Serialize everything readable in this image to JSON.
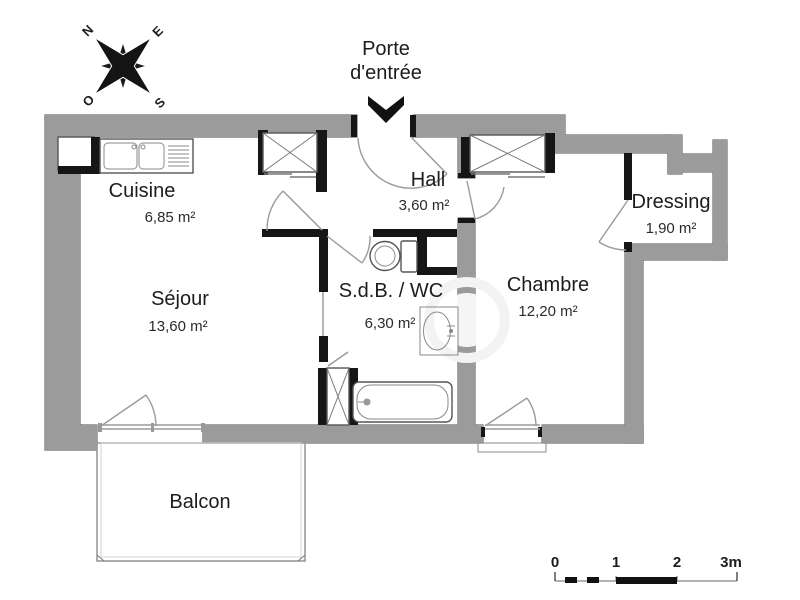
{
  "entry": {
    "line1": "Porte",
    "line2": "d'entrée"
  },
  "compass": {
    "n": "N",
    "e": "E",
    "s": "S",
    "w": "O"
  },
  "rooms": {
    "cuisine": {
      "name": "Cuisine",
      "area": "6,85 m²"
    },
    "hall": {
      "name": "Hall",
      "area": "3,60 m²"
    },
    "dressing": {
      "name": "Dressing",
      "area": "1,90 m²"
    },
    "sejour": {
      "name": "Séjour",
      "area": "13,60 m²"
    },
    "sdb": {
      "name": "S.d.B. / WC",
      "area": "6,30 m²"
    },
    "chambre": {
      "name": "Chambre",
      "area": "12,20 m²"
    },
    "balcon": {
      "name": "Balcon"
    }
  },
  "scale": {
    "t0": "0",
    "t1": "1",
    "t2": "2",
    "t3": "3m"
  },
  "colors": {
    "wall": "#9b9b9b",
    "wall_outline": "#6a6a6a",
    "partition": "#161616",
    "text": "#1c1c1c"
  }
}
